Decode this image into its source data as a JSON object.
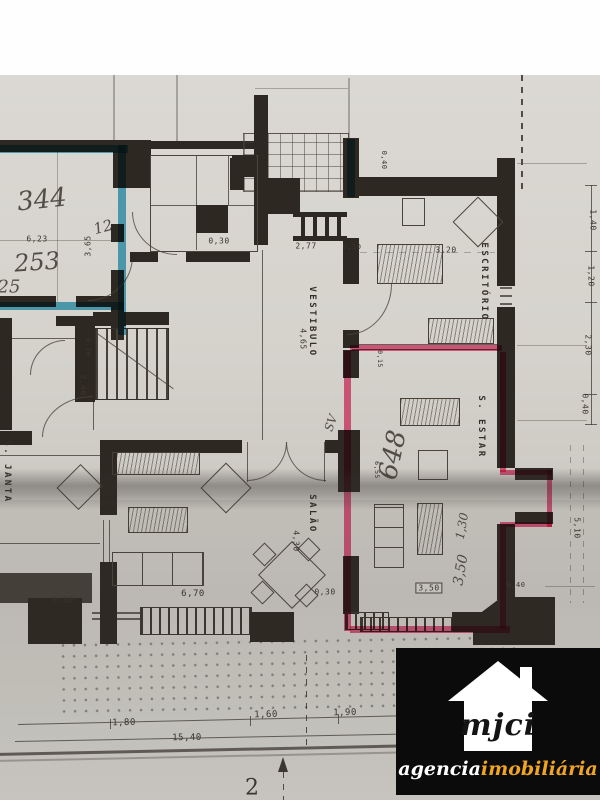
{
  "palette": {
    "paper": "#d6d3cd",
    "wall": "#2e2822",
    "blue_highlight": "#2fa3c6",
    "pink_highlight": "#f3447a",
    "logo_bg": "#0b0b0b",
    "logo_accent": "#f0a522"
  },
  "logo": {
    "brand": "mjci",
    "tagline_white": "agencia",
    "tagline_accent": "imobiliária",
    "icon": "house-icon"
  },
  "floorplan": {
    "rooms": [
      {
        "t": "ESCRITÓRIO",
        "x": 484,
        "y": 282,
        "r": 90,
        "s": 9
      },
      {
        "t": "VESTIBULO",
        "x": 312,
        "y": 322,
        "r": 90,
        "s": 9
      },
      {
        "t": "S. ESTAR",
        "x": 481,
        "y": 427,
        "r": 90,
        "s": 9
      },
      {
        "t": "SALÃO",
        "x": 312,
        "y": 514,
        "r": 90,
        "s": 9
      },
      {
        "t": "S. JANTA",
        "x": 7,
        "y": 472,
        "r": 90,
        "s": 9
      }
    ],
    "dimensions": [
      {
        "t": "6,23",
        "x": 37,
        "y": 239,
        "r": 0,
        "s": 8
      },
      {
        "t": "3,65",
        "x": 88,
        "y": 246,
        "r": -90,
        "s": 8
      },
      {
        "t": "0,30",
        "x": 219,
        "y": 241,
        "r": 0,
        "s": 8
      },
      {
        "t": "2,77",
        "x": 306,
        "y": 246,
        "r": 0,
        "s": 8
      },
      {
        "t": "0,10",
        "x": 352,
        "y": 247,
        "r": 0,
        "s": 7
      },
      {
        "t": "0,40",
        "x": 384,
        "y": 160,
        "r": 90,
        "s": 7
      },
      {
        "t": "3,20",
        "x": 446,
        "y": 250,
        "r": 0,
        "s": 8
      },
      {
        "t": "4,65",
        "x": 303,
        "y": 339,
        "r": 90,
        "s": 8
      },
      {
        "t": "0,20",
        "x": 88,
        "y": 347,
        "r": 90,
        "s": 7
      },
      {
        "t": "2,40",
        "x": 83,
        "y": 385,
        "r": 90,
        "s": 8
      },
      {
        "t": "0,15",
        "x": 380,
        "y": 359,
        "r": 90,
        "s": 6.5
      },
      {
        "t": "6,55",
        "x": 377,
        "y": 470,
        "r": 90,
        "s": 6.5
      },
      {
        "t": "4,30",
        "x": 296,
        "y": 541,
        "r": 90,
        "s": 8
      },
      {
        "t": "6,70",
        "x": 193,
        "y": 594,
        "r": 0,
        "s": 9
      },
      {
        "t": "0,30",
        "x": 63,
        "y": 600,
        "r": 0,
        "s": 8
      },
      {
        "t": "0,30",
        "x": 325,
        "y": 592,
        "r": 0,
        "s": 8
      },
      {
        "t": "0,40",
        "x": 516,
        "y": 585,
        "r": 0,
        "s": 7
      },
      {
        "t": "3,50",
        "x": 429,
        "y": 588,
        "r": 0,
        "s": 8,
        "box": true
      },
      {
        "t": "1,80",
        "x": 124,
        "y": 723,
        "r": -1,
        "s": 9
      },
      {
        "t": "1,60",
        "x": 266,
        "y": 715,
        "r": -1,
        "s": 9
      },
      {
        "t": "1,90",
        "x": 345,
        "y": 713,
        "r": -1,
        "s": 9
      },
      {
        "t": "15,40",
        "x": 187,
        "y": 738,
        "r": -1,
        "s": 9
      },
      {
        "t": "1,40",
        "x": 593,
        "y": 220,
        "r": 90,
        "s": 8
      },
      {
        "t": "1,20",
        "x": 591,
        "y": 276,
        "r": 90,
        "s": 8
      },
      {
        "t": "2,30",
        "x": 588,
        "y": 345,
        "r": 90,
        "s": 8
      },
      {
        "t": "0,40",
        "x": 585,
        "y": 404,
        "r": 90,
        "s": 8
      },
      {
        "t": "5,10",
        "x": 577,
        "y": 528,
        "r": 90,
        "s": 8
      }
    ],
    "handwritten": [
      {
        "t": "344",
        "x": 42,
        "y": 200,
        "r": -6,
        "s": 26
      },
      {
        "t": "253",
        "x": 37,
        "y": 262,
        "r": -4,
        "s": 24
      },
      {
        "t": "12",
        "x": 103,
        "y": 227,
        "r": -15,
        "s": 15
      },
      {
        "t": "25",
        "x": 9,
        "y": 287,
        "r": 0,
        "s": 18
      },
      {
        "t": "648",
        "x": 393,
        "y": 455,
        "r": -78,
        "s": 26
      },
      {
        "t": "SV",
        "x": 331,
        "y": 423,
        "r": -70,
        "s": 12
      },
      {
        "t": "1,30",
        "x": 462,
        "y": 526,
        "r": -80,
        "s": 12
      },
      {
        "t": "3,50",
        "x": 461,
        "y": 570,
        "r": -80,
        "s": 14
      }
    ],
    "marks": [
      {
        "t": "2",
        "x": 252,
        "y": 788,
        "r": 0,
        "s": 22
      }
    ]
  }
}
